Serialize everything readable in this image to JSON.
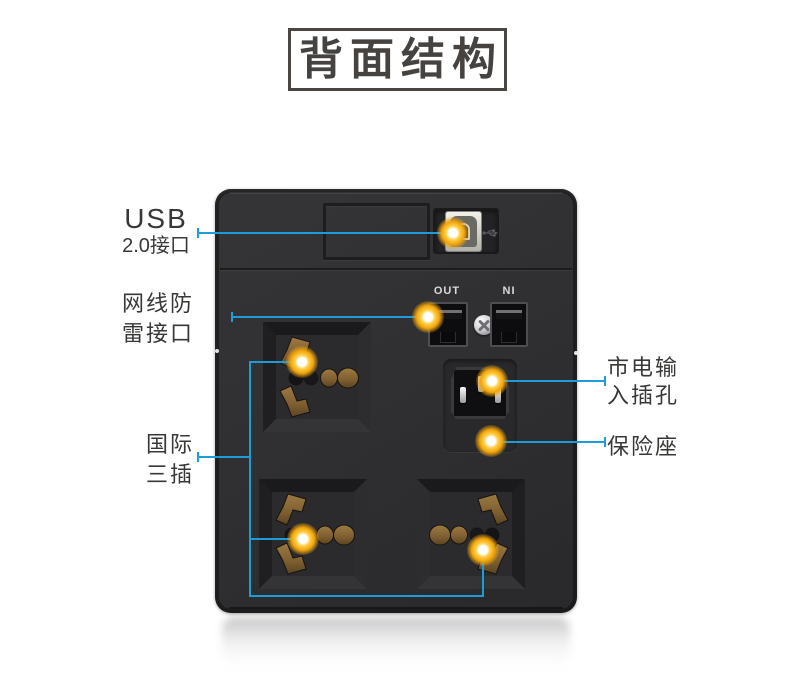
{
  "title": "背面结构",
  "callouts": {
    "usb": {
      "line1": "USB",
      "line2": "2.0接口"
    },
    "lan": {
      "line1": "网线防",
      "line2": "雷接口"
    },
    "intl": {
      "line1": "国际",
      "line2": "三插"
    },
    "mains": {
      "line1": "市电输",
      "line2": "入插孔"
    },
    "fuse": {
      "line1": "保险座"
    }
  },
  "device": {
    "out_label": "OUT",
    "in_label": "NI"
  },
  "icons": {
    "usb_port": "usb-b-port-icon",
    "usb_symbol": "usb-trident-icon",
    "screw": "phillips-screw-icon",
    "network_ports": "rj45-port-icon",
    "sockets": "universal-socket-icon",
    "power_inlet": "c14-inlet-icon",
    "marker": "callout-marker-dot"
  },
  "colors": {
    "callout_blue": "#1e9cd8",
    "marker_gold": "#f1a40a",
    "brass_contact": "#7d5e30",
    "device_body": "#2f2f31",
    "title_text": "#464240"
  }
}
